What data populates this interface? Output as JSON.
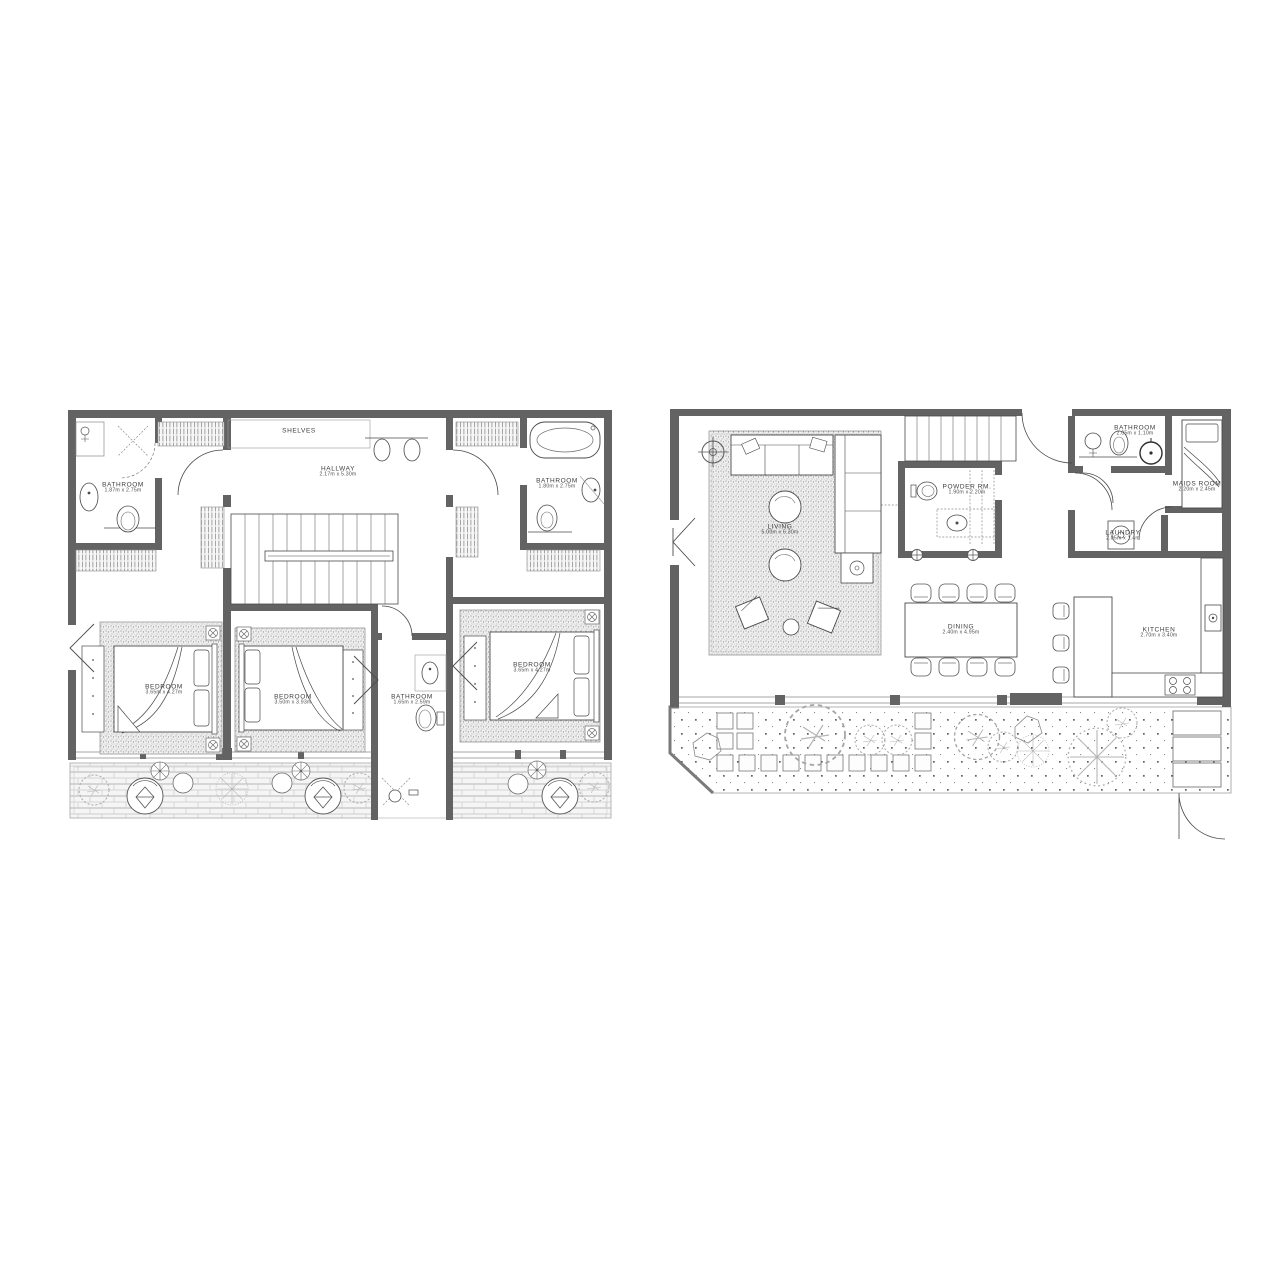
{
  "page": {
    "background": "#ffffff"
  },
  "colors": {
    "wall": "#636363",
    "line": "#4a4a4a",
    "light_line": "#9a9a9a",
    "background": "#ffffff"
  },
  "plans": {
    "upper": {
      "rooms": {
        "bathroom1": {
          "name": "BATHROOM",
          "dims": "1.87m x 2.75m"
        },
        "shelves": {
          "name": "SHELVES"
        },
        "hallway": {
          "name": "HALLWAY",
          "dims": "2.17m x 5.30m"
        },
        "bathroom2": {
          "name": "BATHROOM",
          "dims": "1.80m x 2.75m"
        },
        "bedroom1": {
          "name": "BEDROOM",
          "dims": "3.65m x 4.27m"
        },
        "bedroom2": {
          "name": "BEDROOM",
          "dims": "3.50m x 3.93m"
        },
        "bathroom3": {
          "name": "BATHROOM",
          "dims": "1.65m x 2.59m"
        },
        "bedroom3": {
          "name": "BEDROOM",
          "dims": "3.65m x 4.27m"
        }
      }
    },
    "lower": {
      "rooms": {
        "living": {
          "name": "LIVING",
          "dims": "5.00m x 5.30m"
        },
        "powder": {
          "name": "POWDER RM.",
          "dims": "1.90m x 2.20m"
        },
        "bathroom": {
          "name": "BATHROOM",
          "dims": "2.05m x 1.10m"
        },
        "maids": {
          "name": "MAIDS ROOM",
          "dims": "2.20m x 2.45m"
        },
        "laundry": {
          "name": "LAUNDRY",
          "dims": "2.05m x 1.4m"
        },
        "dining": {
          "name": "DINING",
          "dims": "2.40m x 4.95m"
        },
        "kitchen": {
          "name": "KITCHEN",
          "dims": "2.70m x 3.40m"
        }
      }
    }
  }
}
